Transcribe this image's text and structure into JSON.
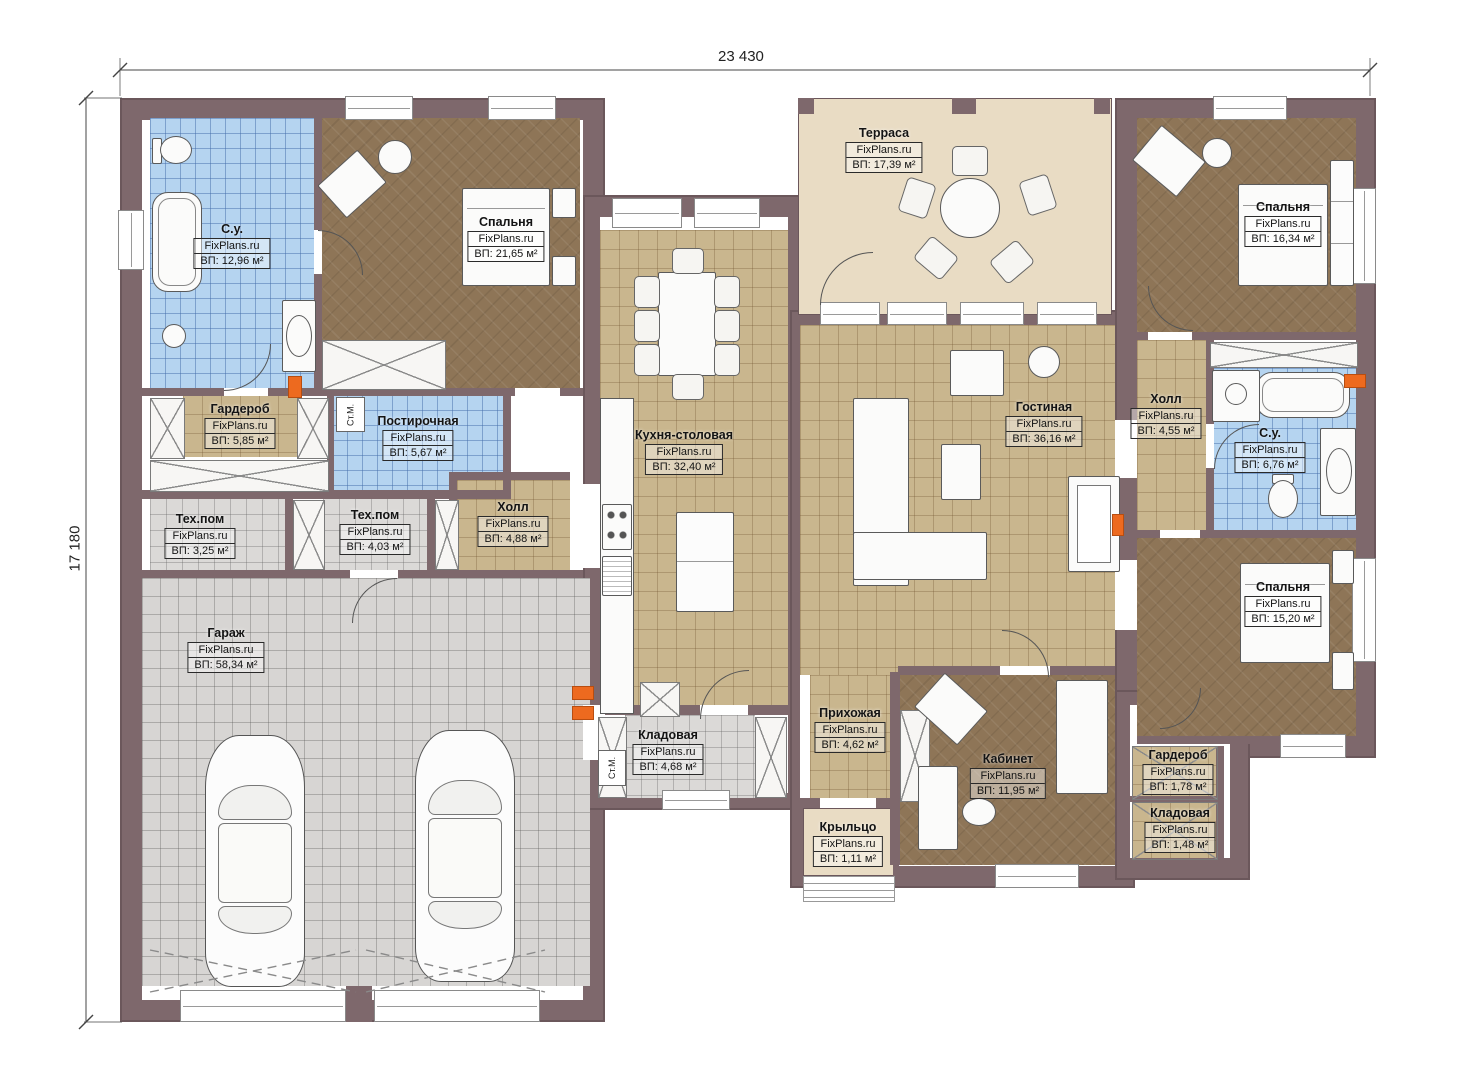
{
  "site_watermark": "FixPlans.ru",
  "dimensions": {
    "width_label": "23 430",
    "height_label": "17 180"
  },
  "labels": {
    "washing_machine": "Ст.М."
  },
  "colors": {
    "wall": "#7e686c",
    "tile_tan": "#c9b68e",
    "tile_blue": "#b5d4f0",
    "tile_gray": "#dbd9d7",
    "floor_brown": "#8e7557",
    "terrace": "#e9dcc4",
    "marker_orange": "#ed6a1f"
  },
  "rooms": {
    "su1": {
      "name": "С.у.",
      "wm": "FixPlans.ru",
      "area": "ВП: 12,96 м²"
    },
    "bed1": {
      "name": "Спальня",
      "wm": "FixPlans.ru",
      "area": "ВП: 21,65 м²"
    },
    "wardrobe1": {
      "name": "Гардероб",
      "wm": "FixPlans.ru",
      "area": "ВП: 5,85 м²"
    },
    "laundry": {
      "name": "Постирочная",
      "wm": "FixPlans.ru",
      "area": "ВП: 5,67 м²"
    },
    "tech1": {
      "name": "Тех.пом",
      "wm": "FixPlans.ru",
      "area": "ВП: 3,25 м²"
    },
    "tech2": {
      "name": "Тех.пом",
      "wm": "FixPlans.ru",
      "area": "ВП: 4,03 м²"
    },
    "hall1": {
      "name": "Холл",
      "wm": "FixPlans.ru",
      "area": "ВП: 4,88 м²"
    },
    "garage": {
      "name": "Гараж",
      "wm": "FixPlans.ru",
      "area": "ВП: 58,34 м²"
    },
    "kitchen": {
      "name": "Кухня-столовая",
      "wm": "FixPlans.ru",
      "area": "ВП: 32,40 м²"
    },
    "storage1": {
      "name": "Кладовая",
      "wm": "FixPlans.ru",
      "area": "ВП: 4,68 м²"
    },
    "terrace": {
      "name": "Терраса",
      "wm": "FixPlans.ru",
      "area": "ВП: 17,39 м²"
    },
    "living": {
      "name": "Гостиная",
      "wm": "FixPlans.ru",
      "area": "ВП: 36,16 м²"
    },
    "hallway": {
      "name": "Прихожая",
      "wm": "FixPlans.ru",
      "area": "ВП: 4,62 м²"
    },
    "office": {
      "name": "Кабинет",
      "wm": "FixPlans.ru",
      "area": "ВП: 11,95 м²"
    },
    "porch": {
      "name": "Крыльцо",
      "wm": "FixPlans.ru",
      "area": "ВП: 1,11 м²"
    },
    "bed2": {
      "name": "Спальня",
      "wm": "FixPlans.ru",
      "area": "ВП: 16,34 м²"
    },
    "hall2": {
      "name": "Холл",
      "wm": "FixPlans.ru",
      "area": "ВП: 4,55 м²"
    },
    "su2": {
      "name": "С.у.",
      "wm": "FixPlans.ru",
      "area": "ВП: 6,76 м²"
    },
    "bed3": {
      "name": "Спальня",
      "wm": "FixPlans.ru",
      "area": "ВП: 15,20 м²"
    },
    "wardrobe2": {
      "name": "Гардероб",
      "wm": "FixPlans.ru",
      "area": "ВП: 1,78 м²"
    },
    "storage2": {
      "name": "Кладовая",
      "wm": "FixPlans.ru",
      "area": "ВП: 1,48 м²"
    }
  }
}
